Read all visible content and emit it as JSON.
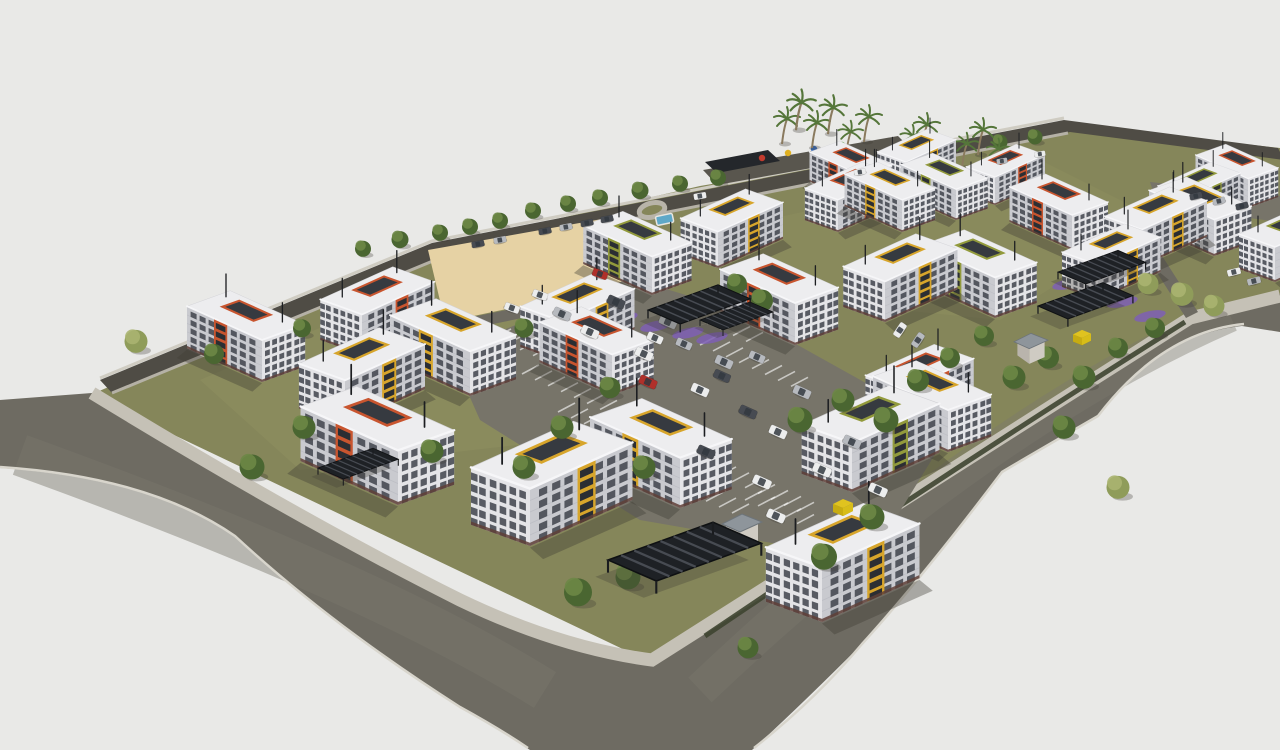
{
  "meta": {
    "title": "Aerial 3D architectural rendering of a residential apartment complex",
    "render_type": "site masterplan perspective, no visible text or UI"
  },
  "palette": {
    "background": "#e9e9e7",
    "road": "#6e6b62",
    "road_dark": "#4f4c45",
    "sidewalk": "#c5c1b6",
    "grass": "#85865a",
    "grass_light": "#949564",
    "sand": "#e6d2a4",
    "facade_light": "#e4e4e7",
    "facade_shade": "#c9cacf",
    "roof": "#ededef",
    "window": "#3f434b",
    "accent_orange": "#c8552f",
    "accent_yellow": "#d7a52b",
    "accent_olive": "#929a3c",
    "tree_dark": "#4a6631",
    "tree_highlight": "#6d8746",
    "tree_light": "#9aa565",
    "canopy": "#24272b",
    "wall": "#514e47",
    "purple_bed": "#7e5fb5",
    "pool_blue": "#5fa8c8",
    "dumpster_yellow": "#e0c31f",
    "car_white": "#eceded",
    "car_silver": "#b7babf",
    "car_dark": "#474b52",
    "car_red": "#b0302a",
    "shadow": "#3f3c35"
  },
  "scene": {
    "counts": {
      "apartment_buildings": 31,
      "trees": 49,
      "palm_trees": 11,
      "cars": 38,
      "carport_canopies": 6,
      "guard_houses": 2,
      "dumpsters": 2,
      "pools": 1
    },
    "buildings": [
      {
        "x": 862,
        "y": 205,
        "s": 0.42,
        "m": 0,
        "a": "accent_orange"
      },
      {
        "x": 906,
        "y": 190,
        "s": 0.4,
        "m": 1,
        "a": "accent_yellow"
      },
      {
        "x": 838,
        "y": 232,
        "s": 0.46,
        "m": 1,
        "a": "accent_orange"
      },
      {
        "x": 902,
        "y": 232,
        "s": 0.46,
        "m": 0,
        "a": "accent_yellow"
      },
      {
        "x": 956,
        "y": 220,
        "s": 0.44,
        "m": 0,
        "a": "accent_olive"
      },
      {
        "x": 995,
        "y": 205,
        "s": 0.4,
        "m": 1,
        "a": "accent_orange"
      },
      {
        "x": 652,
        "y": 295,
        "s": 0.55,
        "m": 0,
        "a": "accent_olive"
      },
      {
        "x": 718,
        "y": 268,
        "s": 0.52,
        "m": 1,
        "a": "accent_yellow"
      },
      {
        "x": 1072,
        "y": 250,
        "s": 0.5,
        "m": 0,
        "a": "accent_orange"
      },
      {
        "x": 1142,
        "y": 266,
        "s": 0.52,
        "m": 1,
        "a": "accent_yellow"
      },
      {
        "x": 1214,
        "y": 256,
        "s": 0.52,
        "m": 0,
        "a": "accent_yellow"
      },
      {
        "x": 1275,
        "y": 282,
        "s": 0.5,
        "m": 1,
        "a": "accent_olive"
      },
      {
        "x": 1248,
        "y": 208,
        "s": 0.42,
        "m": 0,
        "a": "accent_orange"
      },
      {
        "x": 1188,
        "y": 226,
        "s": 0.42,
        "m": 1,
        "a": "accent_olive"
      },
      {
        "x": 795,
        "y": 345,
        "s": 0.6,
        "m": 0,
        "a": "accent_orange"
      },
      {
        "x": 885,
        "y": 322,
        "s": 0.58,
        "m": 1,
        "a": "accent_yellow"
      },
      {
        "x": 995,
        "y": 318,
        "s": 0.58,
        "m": 0,
        "a": "accent_olive"
      },
      {
        "x": 1098,
        "y": 300,
        "s": 0.5,
        "m": 1,
        "a": "accent_yellow"
      },
      {
        "x": 262,
        "y": 382,
        "s": 0.6,
        "m": 0,
        "a": "accent_orange"
      },
      {
        "x": 362,
        "y": 355,
        "s": 0.58,
        "m": 1,
        "a": "accent_orange"
      },
      {
        "x": 345,
        "y": 425,
        "s": 0.64,
        "m": 1,
        "a": "accent_yellow"
      },
      {
        "x": 470,
        "y": 396,
        "s": 0.64,
        "m": 0,
        "a": "accent_yellow"
      },
      {
        "x": 562,
        "y": 362,
        "s": 0.58,
        "m": 1,
        "a": "accent_yellow"
      },
      {
        "x": 612,
        "y": 395,
        "s": 0.58,
        "m": 0,
        "a": "accent_orange"
      },
      {
        "x": 398,
        "y": 505,
        "s": 0.78,
        "m": 0,
        "a": "accent_orange"
      },
      {
        "x": 530,
        "y": 546,
        "s": 0.82,
        "m": 1,
        "a": "accent_yellow"
      },
      {
        "x": 680,
        "y": 508,
        "s": 0.72,
        "m": 0,
        "a": "accent_yellow"
      },
      {
        "x": 852,
        "y": 492,
        "s": 0.7,
        "m": 1,
        "a": "accent_olive"
      },
      {
        "x": 948,
        "y": 452,
        "s": 0.6,
        "m": 0,
        "a": "accent_yellow"
      },
      {
        "x": 905,
        "y": 428,
        "s": 0.55,
        "m": 1,
        "a": "accent_orange"
      },
      {
        "x": 822,
        "y": 622,
        "s": 0.78,
        "m": 1,
        "a": "accent_yellow"
      }
    ],
    "trees": [
      [
        363,
        252,
        0.8,
        0
      ],
      [
        400,
        243,
        0.85,
        0
      ],
      [
        440,
        236,
        0.8,
        0
      ],
      [
        470,
        230,
        0.8,
        0
      ],
      [
        500,
        224,
        0.8,
        0
      ],
      [
        533,
        214,
        0.8,
        0
      ],
      [
        568,
        207,
        0.8,
        0
      ],
      [
        600,
        201,
        0.8,
        0
      ],
      [
        640,
        194,
        0.85,
        0
      ],
      [
        680,
        187,
        0.8,
        0
      ],
      [
        718,
        181,
        0.8,
        0
      ],
      [
        940,
        152,
        0.75,
        0
      ],
      [
        1000,
        145,
        0.75,
        0
      ],
      [
        1035,
        140,
        0.75,
        0
      ],
      [
        708,
        305,
        1.1,
        0
      ],
      [
        737,
        288,
        1.0,
        0
      ],
      [
        762,
        305,
        1.1,
        0
      ],
      [
        800,
        425,
        1.25,
        0
      ],
      [
        843,
        405,
        1.15,
        0
      ],
      [
        886,
        425,
        1.25,
        0
      ],
      [
        918,
        385,
        1.1,
        0
      ],
      [
        950,
        362,
        1.0,
        0
      ],
      [
        984,
        340,
        1.0,
        0
      ],
      [
        1014,
        382,
        1.15,
        0
      ],
      [
        1048,
        362,
        1.1,
        0
      ],
      [
        1084,
        382,
        1.15,
        0
      ],
      [
        1118,
        352,
        1.0,
        0
      ],
      [
        1155,
        332,
        1.0,
        0
      ],
      [
        136,
        346,
        1.15,
        1
      ],
      [
        214,
        358,
        1.0,
        0
      ],
      [
        302,
        332,
        0.9,
        0
      ],
      [
        524,
        332,
        0.95,
        0
      ],
      [
        610,
        392,
        1.05,
        0
      ],
      [
        562,
        432,
        1.15,
        0
      ],
      [
        304,
        432,
        1.15,
        0
      ],
      [
        252,
        472,
        1.25,
        0
      ],
      [
        432,
        456,
        1.15,
        0
      ],
      [
        524,
        472,
        1.15,
        0
      ],
      [
        644,
        472,
        1.15,
        0
      ],
      [
        578,
        598,
        1.4,
        0
      ],
      [
        628,
        582,
        1.25,
        0
      ],
      [
        872,
        522,
        1.25,
        0
      ],
      [
        824,
        562,
        1.3,
        0
      ],
      [
        1064,
        432,
        1.15,
        0
      ],
      [
        748,
        652,
        1.05,
        0
      ],
      [
        1148,
        288,
        1.05,
        1
      ],
      [
        1182,
        299,
        1.15,
        1
      ],
      [
        1214,
        310,
        1.05,
        1
      ],
      [
        1118,
        492,
        1.15,
        1
      ]
    ],
    "palms": [
      [
        782,
        142,
        1
      ],
      [
        796,
        128,
        1.1
      ],
      [
        812,
        146,
        1
      ],
      [
        828,
        132,
        1.05
      ],
      [
        846,
        154,
        0.95
      ],
      [
        864,
        140,
        1
      ],
      [
        908,
        158,
        0.95
      ],
      [
        922,
        148,
        1
      ],
      [
        962,
        166,
        0.95
      ],
      [
        978,
        153,
        1
      ],
      [
        994,
        170,
        0.9
      ]
    ],
    "cars": [
      [
        562,
        314,
        24,
        "car_silver",
        1
      ],
      [
        590,
        332,
        24,
        "car_white",
        1
      ],
      [
        616,
        302,
        24,
        "car_dark",
        1
      ],
      [
        644,
        354,
        24,
        "car_white",
        1
      ],
      [
        668,
        322,
        24,
        "car_silver",
        1
      ],
      [
        700,
        390,
        24,
        "car_white",
        1
      ],
      [
        724,
        362,
        24,
        "car_silver",
        1
      ],
      [
        748,
        412,
        24,
        "car_dark",
        1
      ],
      [
        778,
        432,
        24,
        "car_white",
        1
      ],
      [
        802,
        392,
        24,
        "car_silver",
        1
      ],
      [
        648,
        382,
        24,
        "car_red",
        1
      ],
      [
        822,
        470,
        24,
        "car_white",
        1.05
      ],
      [
        852,
        442,
        24,
        "car_silver",
        1
      ],
      [
        706,
        452,
        24,
        "car_dark",
        1
      ],
      [
        762,
        482,
        24,
        "car_white",
        1.05
      ],
      [
        878,
        490,
        24,
        "car_white",
        1.05
      ],
      [
        655,
        338,
        24,
        "car_white",
        0.9
      ],
      [
        684,
        344,
        24,
        "car_silver",
        0.9
      ],
      [
        757,
        357,
        24,
        "car_silver",
        0.9
      ],
      [
        722,
        376,
        24,
        "car_dark",
        0.95
      ],
      [
        545,
        231,
        -11,
        "car_dark",
        0.7
      ],
      [
        566,
        227,
        -11,
        "car_silver",
        0.7
      ],
      [
        587,
        223,
        -11,
        "car_dark",
        0.7
      ],
      [
        607,
        219,
        -11,
        "car_dark",
        0.7
      ],
      [
        500,
        240,
        -11,
        "car_silver",
        0.7
      ],
      [
        478,
        244,
        -11,
        "car_dark",
        0.7
      ],
      [
        700,
        196,
        -10,
        "car_white",
        0.7
      ],
      [
        860,
        172,
        -10,
        "car_white",
        0.65
      ],
      [
        600,
        274,
        20,
        "car_red",
        0.85
      ],
      [
        540,
        295,
        20,
        "car_white",
        0.85
      ],
      [
        512,
        308,
        20,
        "car_white",
        0.85
      ],
      [
        1196,
        196,
        -14,
        "car_dark",
        0.7
      ],
      [
        1219,
        201,
        -14,
        "car_silver",
        0.7
      ],
      [
        1242,
        206,
        -14,
        "car_dark",
        0.7
      ],
      [
        1234,
        272,
        -14,
        "car_white",
        0.75
      ],
      [
        1254,
        281,
        -14,
        "car_silver",
        0.75
      ],
      [
        1002,
        161,
        -10,
        "car_silver",
        0.6
      ],
      [
        1040,
        154,
        -10,
        "car_white",
        0.6
      ],
      [
        776,
        516,
        24,
        "car_white",
        1.05
      ],
      [
        900,
        330,
        -56,
        "car_white",
        0.85
      ],
      [
        918,
        340,
        -56,
        "car_silver",
        0.85
      ]
    ],
    "canopies": [
      [
        608,
        560,
        1.05
      ],
      [
        318,
        468,
        0.55
      ],
      [
        648,
        310,
        0.7
      ],
      [
        700,
        320,
        0.5
      ],
      [
        1058,
        272,
        0.6
      ],
      [
        1038,
        306,
        0.65
      ]
    ],
    "guard_houses": [
      [
        762,
        536,
        1
      ],
      [
        1048,
        352,
        0.85
      ]
    ],
    "dumpsters": [
      [
        843,
        508,
        1
      ],
      [
        1082,
        338,
        0.9
      ]
    ],
    "purple_beds": [
      [
        622,
        318
      ],
      [
        656,
        326
      ],
      [
        688,
        333
      ],
      [
        712,
        338
      ],
      [
        1068,
        284
      ],
      [
        1122,
        302
      ],
      [
        1150,
        316
      ]
    ],
    "stall_rows": [
      [
        494,
        338,
        10
      ],
      [
        522,
        374,
        12
      ],
      [
        558,
        412,
        12
      ],
      [
        602,
        454,
        11
      ],
      [
        668,
        306,
        7
      ],
      [
        700,
        345,
        8
      ],
      [
        706,
        470,
        8
      ],
      [
        745,
        500,
        7
      ]
    ],
    "playground_dots": [
      [
        762,
        158,
        "#c23b2e"
      ],
      [
        788,
        153,
        "#e0b020"
      ],
      [
        814,
        149,
        "#3a6fc0"
      ],
      [
        842,
        145,
        "#4a9a3a"
      ]
    ]
  }
}
